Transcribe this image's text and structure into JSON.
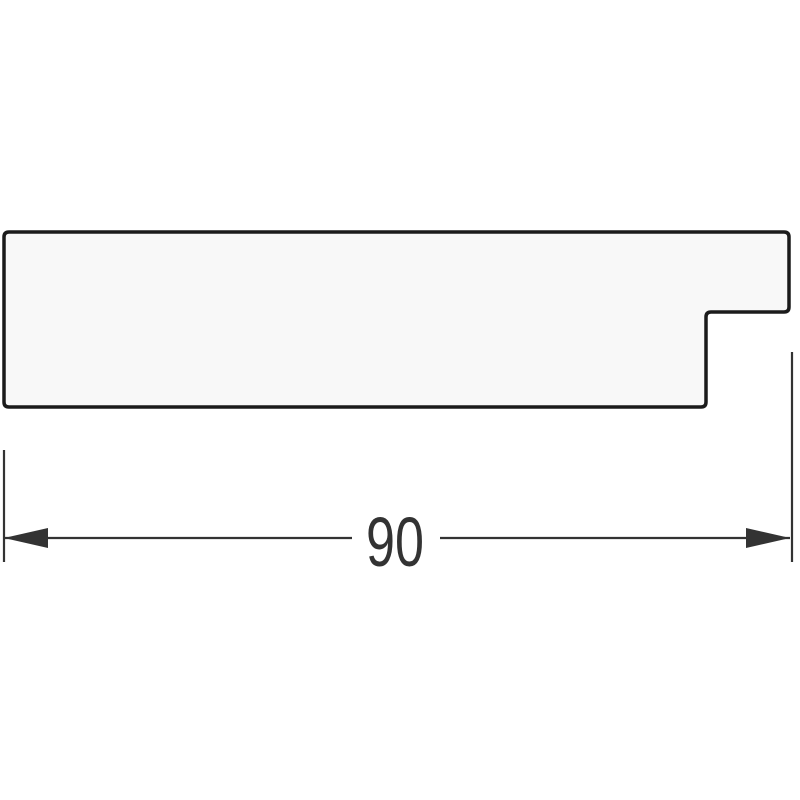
{
  "diagram": {
    "type": "technical-cross-section",
    "subject": "frame-moulding-profile",
    "dimension": {
      "value": "90"
    },
    "colors": {
      "background": "#ffffff",
      "profile_fill": "#f8f8f8",
      "profile_stroke": "#1b1b1b",
      "dimension_color": "#333333"
    },
    "profile": {
      "points": [
        [
          4,
          232
        ],
        [
          789,
          232
        ],
        [
          789,
          312
        ],
        [
          706,
          312
        ],
        [
          706,
          407
        ],
        [
          4,
          407
        ]
      ],
      "corner_radius": 5,
      "stroke_width": 3.5
    },
    "dimension_geometry": {
      "line_y": 538,
      "left_segment": {
        "x1": 4,
        "x2": 352
      },
      "right_segment": {
        "x1": 440,
        "x2": 790
      },
      "label_x_center": 395,
      "label_baseline_y": 566,
      "label_text_length": 58,
      "extension_left": {
        "x": 4,
        "y1": 450,
        "y2": 562
      },
      "extension_right": {
        "x": 792,
        "y1": 352,
        "y2": 562
      },
      "arrow_length": 44,
      "arrow_half_width": 10
    }
  }
}
